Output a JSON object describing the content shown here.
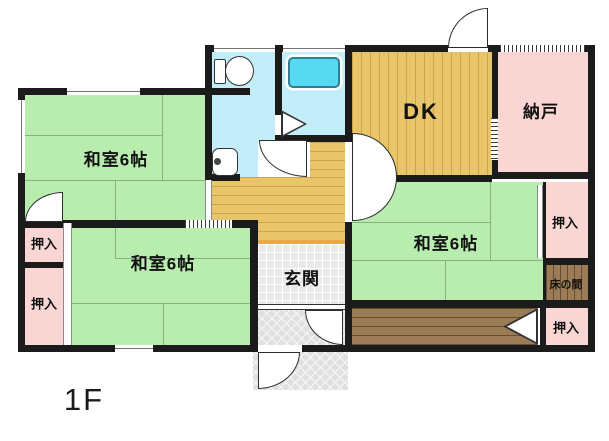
{
  "floor_label": "1F",
  "rooms": {
    "washitsu_nw": {
      "label": "和室6帖"
    },
    "washitsu_south": {
      "label": "和室6帖"
    },
    "washitsu_east": {
      "label": "和室6帖"
    },
    "dk": {
      "label": "DK"
    },
    "nando": {
      "label": "納戸"
    },
    "genkan": {
      "label": "玄関"
    },
    "tokonoma": {
      "label": "床の間"
    },
    "oshiire_west_upper": {
      "label": "押入"
    },
    "oshiire_west_lower": {
      "label": "押入"
    },
    "oshiire_east_upper": {
      "label": "押入"
    },
    "oshiire_east_lower": {
      "label": "押入"
    }
  },
  "colors": {
    "wall": "#1b1b1b",
    "tatami_green": "#b9edb0",
    "tatami_line": "#86b183",
    "closet_pink": "#f9d6d4",
    "bath_blue": "#c3edf8",
    "tub_cyan": "#57d9f1",
    "wood_floor": "#e8c56a",
    "wood_floor_line": "#cda443",
    "dark_wood": "#9b7c57",
    "genkan_gray": "#e9e9e9",
    "porch_gray": "#e0e0e0",
    "step_orange": "#e9a94c",
    "fixture_outline": "#333333"
  }
}
